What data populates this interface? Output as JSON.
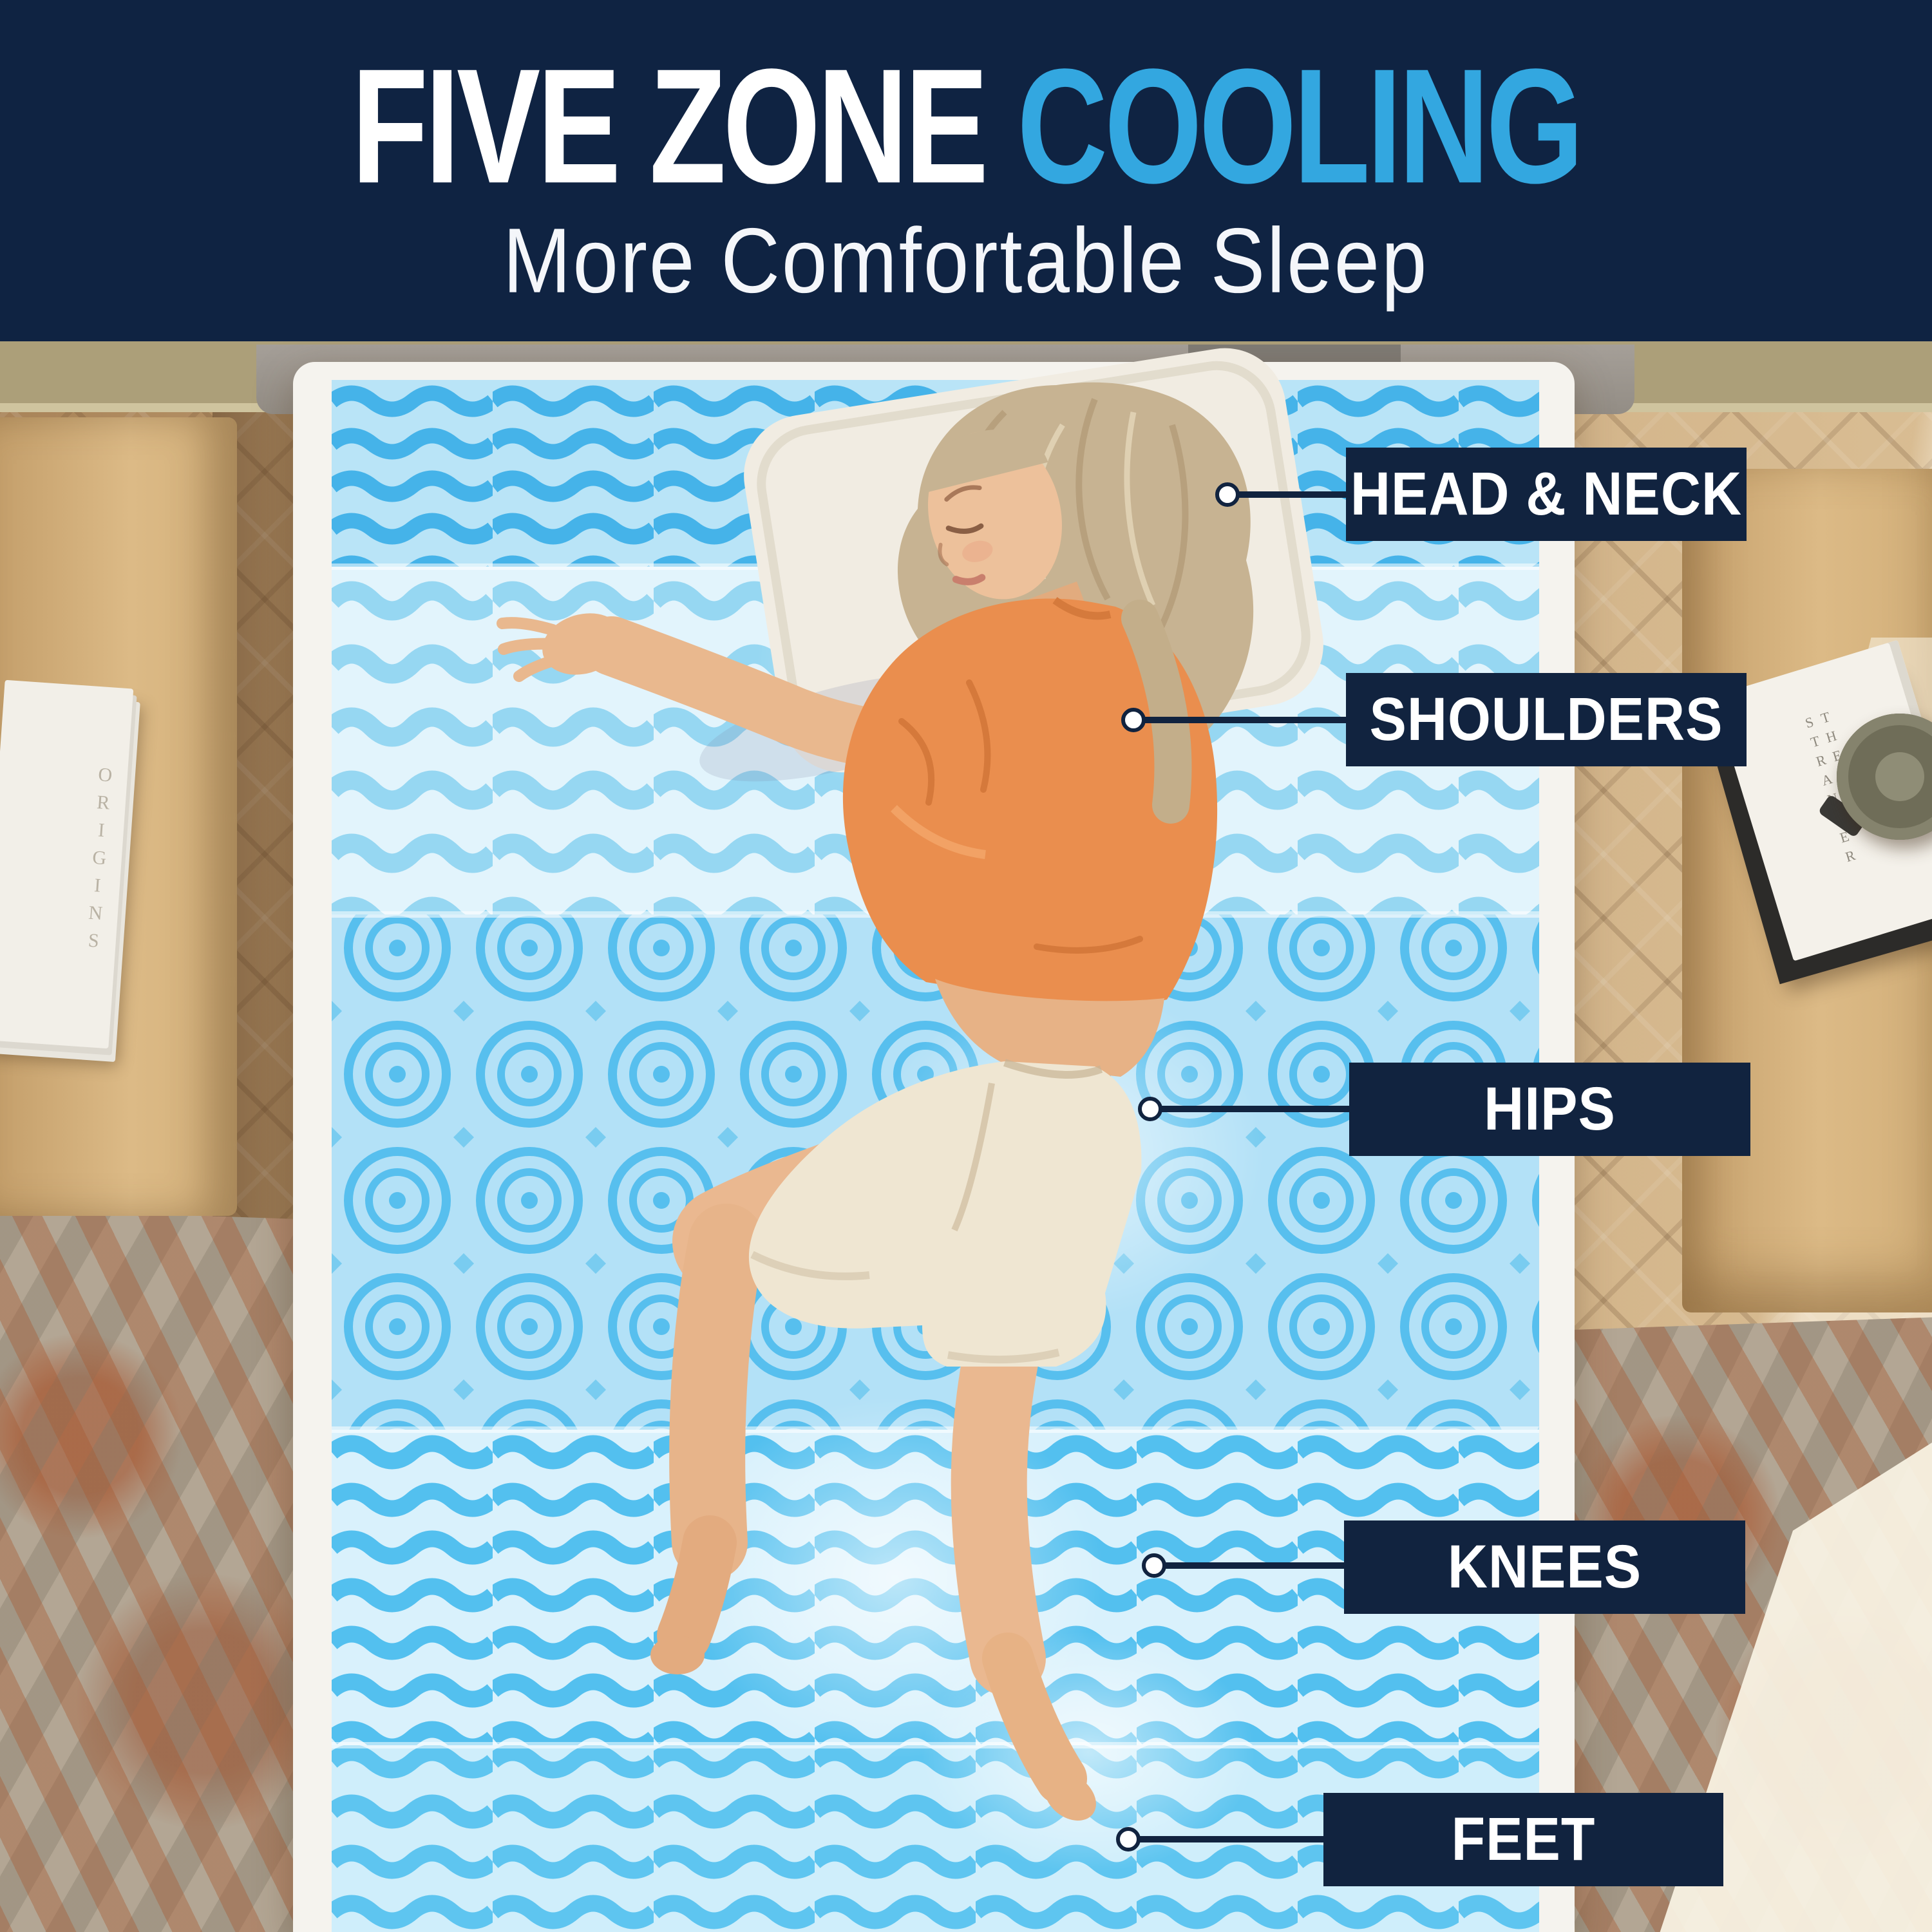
{
  "header": {
    "title": {
      "primary": "FIVE ZONE",
      "accent": "COOLING"
    },
    "subtitle": "More Comfortable Sleep"
  },
  "callouts": [
    {
      "text": "HEAD & NECK"
    },
    {
      "text": "SHOULDERS"
    },
    {
      "text": "HIPS"
    },
    {
      "text": "KNEES"
    },
    {
      "text": "FEET"
    }
  ],
  "scene": {
    "right_nightstand_book_title": "THE STRANGER",
    "left_nightstand_book_text": "ORIGINS"
  },
  "colors": {
    "header_navy": "#0f2342",
    "title_accent_blue": "#33a7e0",
    "label_bg_navy": "#11233f",
    "label_text": "#ffffff",
    "topper_wave_blue": "#53c0ef",
    "topper_base_blue": "#d9f1fc",
    "bed_white": "#f5f3ee",
    "floor_wood": "#c6a679",
    "shirt_orange": "#ea8e4e",
    "shorts_cream": "#efe6d2"
  },
  "icons": {
    "callout_dot": "white circle with navy ring"
  }
}
